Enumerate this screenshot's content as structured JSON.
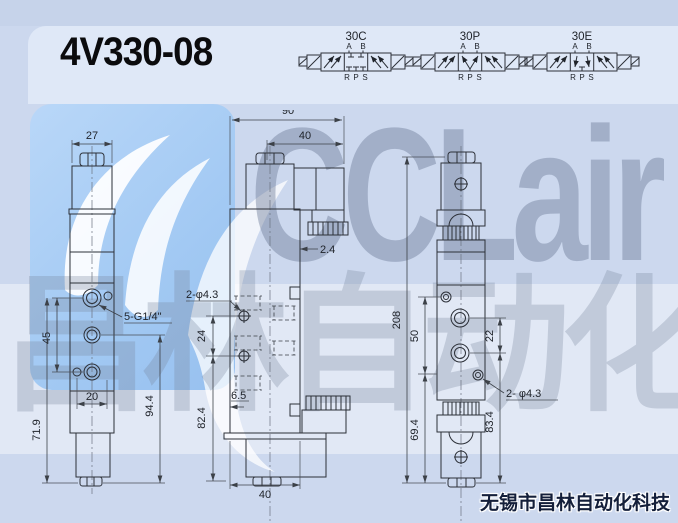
{
  "title": "4V330-08",
  "footer": {
    "company": "无锡市昌林自动化科技"
  },
  "watermark": {
    "logo_text": "CCLair",
    "cn_text": "昌林自动化"
  },
  "schematics": {
    "items": [
      {
        "label": "30C",
        "port_a": "A",
        "port_b": "B",
        "port_r": "R",
        "port_p": "P",
        "port_s": "S",
        "center_type": "closed"
      },
      {
        "label": "30P",
        "port_a": "A",
        "port_b": "B",
        "port_r": "R",
        "port_p": "P",
        "port_s": "S",
        "center_type": "pressure"
      },
      {
        "label": "30E",
        "port_a": "A",
        "port_b": "B",
        "port_r": "R",
        "port_p": "P",
        "port_s": "S",
        "center_type": "exhaust"
      }
    ]
  },
  "front_view": {
    "dim_width": "27",
    "dim_port_pitch": "45",
    "dim_port_width": "20",
    "dim_lower_height": "71.9",
    "dim_body_height": "94.4",
    "thread_label": "5-G1/4\""
  },
  "side_view": {
    "dim_total_width": "90",
    "dim_coil_width": "40",
    "dim_offset": "2.4",
    "holes_label": "2-φ4.3",
    "dim_hole_pitch": "24",
    "dim_edge_offset": "6.5",
    "dim_body_height": "82.4",
    "dim_body_width": "40"
  },
  "rear_view": {
    "dim_total_height": "208",
    "dim_hole_pitch": "50",
    "dim_port_pitch": "22",
    "holes_label": "2- φ4.3",
    "dim_lower_height": "69.4",
    "dim_right_height": "83.4"
  }
}
